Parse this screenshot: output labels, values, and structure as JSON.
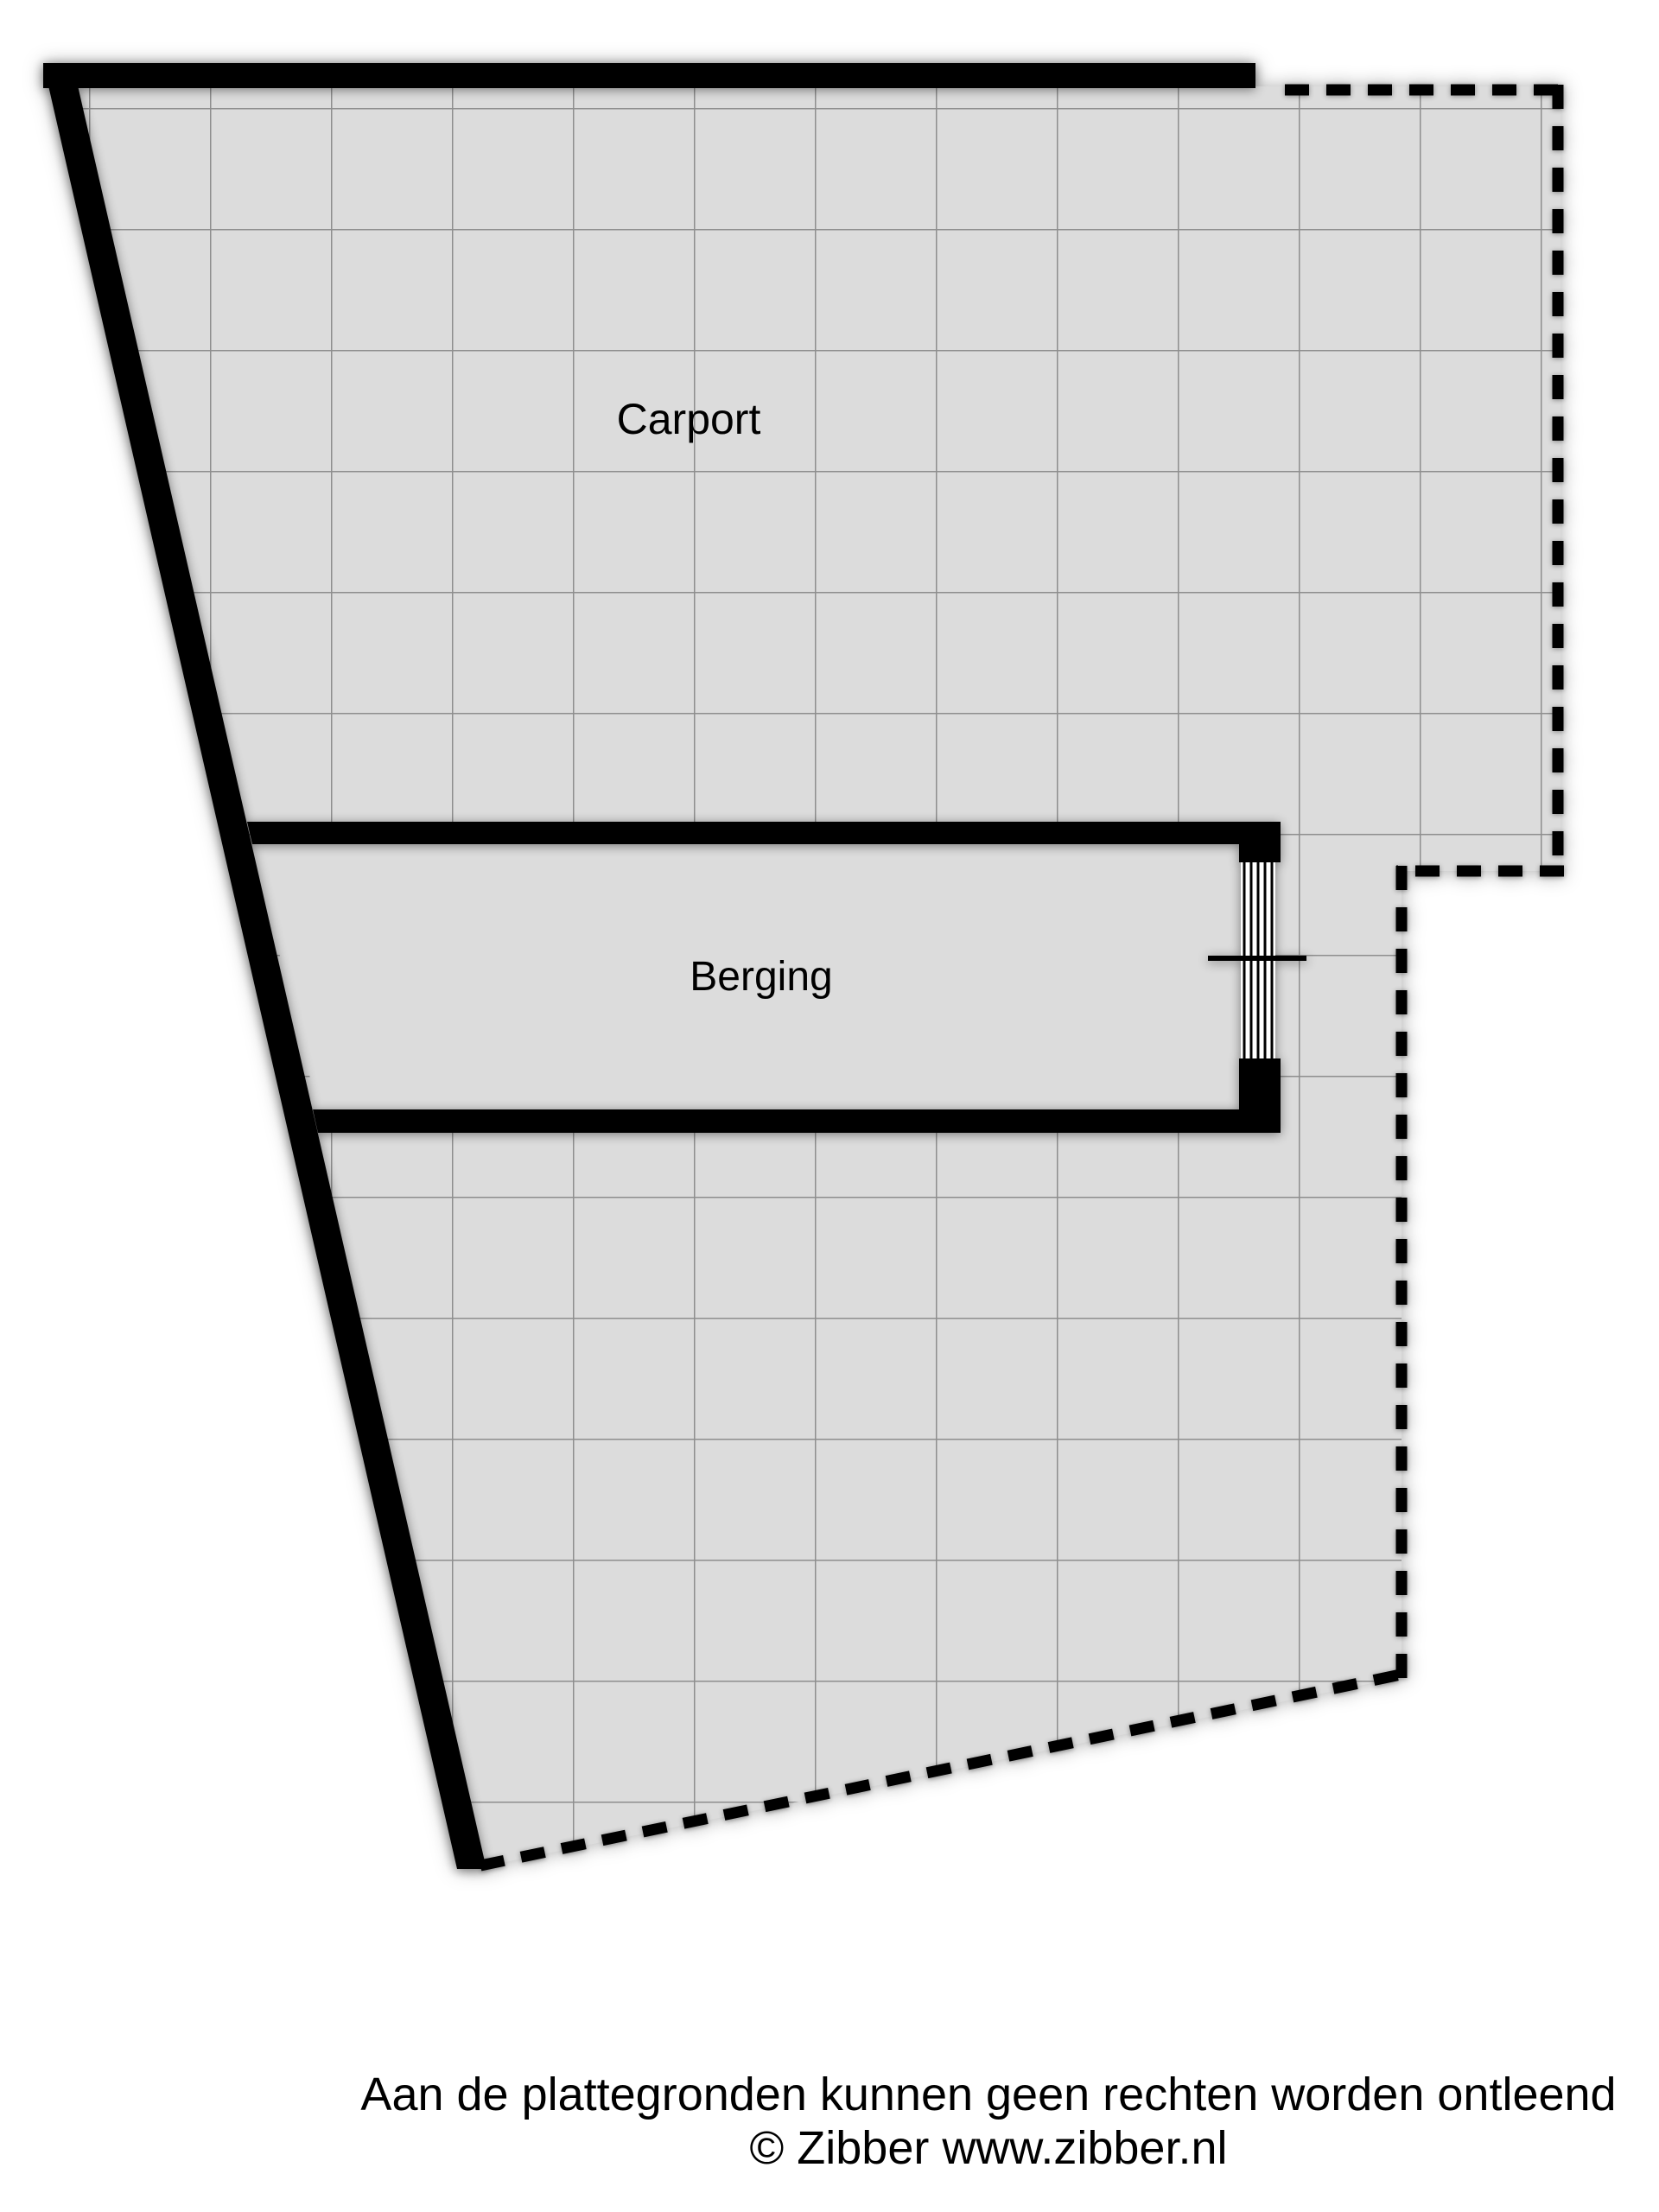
{
  "page": {
    "background_color": "#ffffff"
  },
  "floorplan": {
    "type": "floor-plan",
    "rooms": [
      {
        "id": "carport",
        "label": "Carport"
      },
      {
        "id": "berging",
        "label": "Berging"
      }
    ],
    "colors": {
      "area_fill": "#dcdcdc",
      "grid_line": "#8e8e8e",
      "wall": "#000000",
      "boundary_dash": "#000000",
      "window_fill": "#ffffff"
    }
  },
  "footer": {
    "disclaimer": "Aan de plattegronden kunnen geen rechten worden ontleend",
    "credit": "© Zibber www.zibber.nl"
  }
}
